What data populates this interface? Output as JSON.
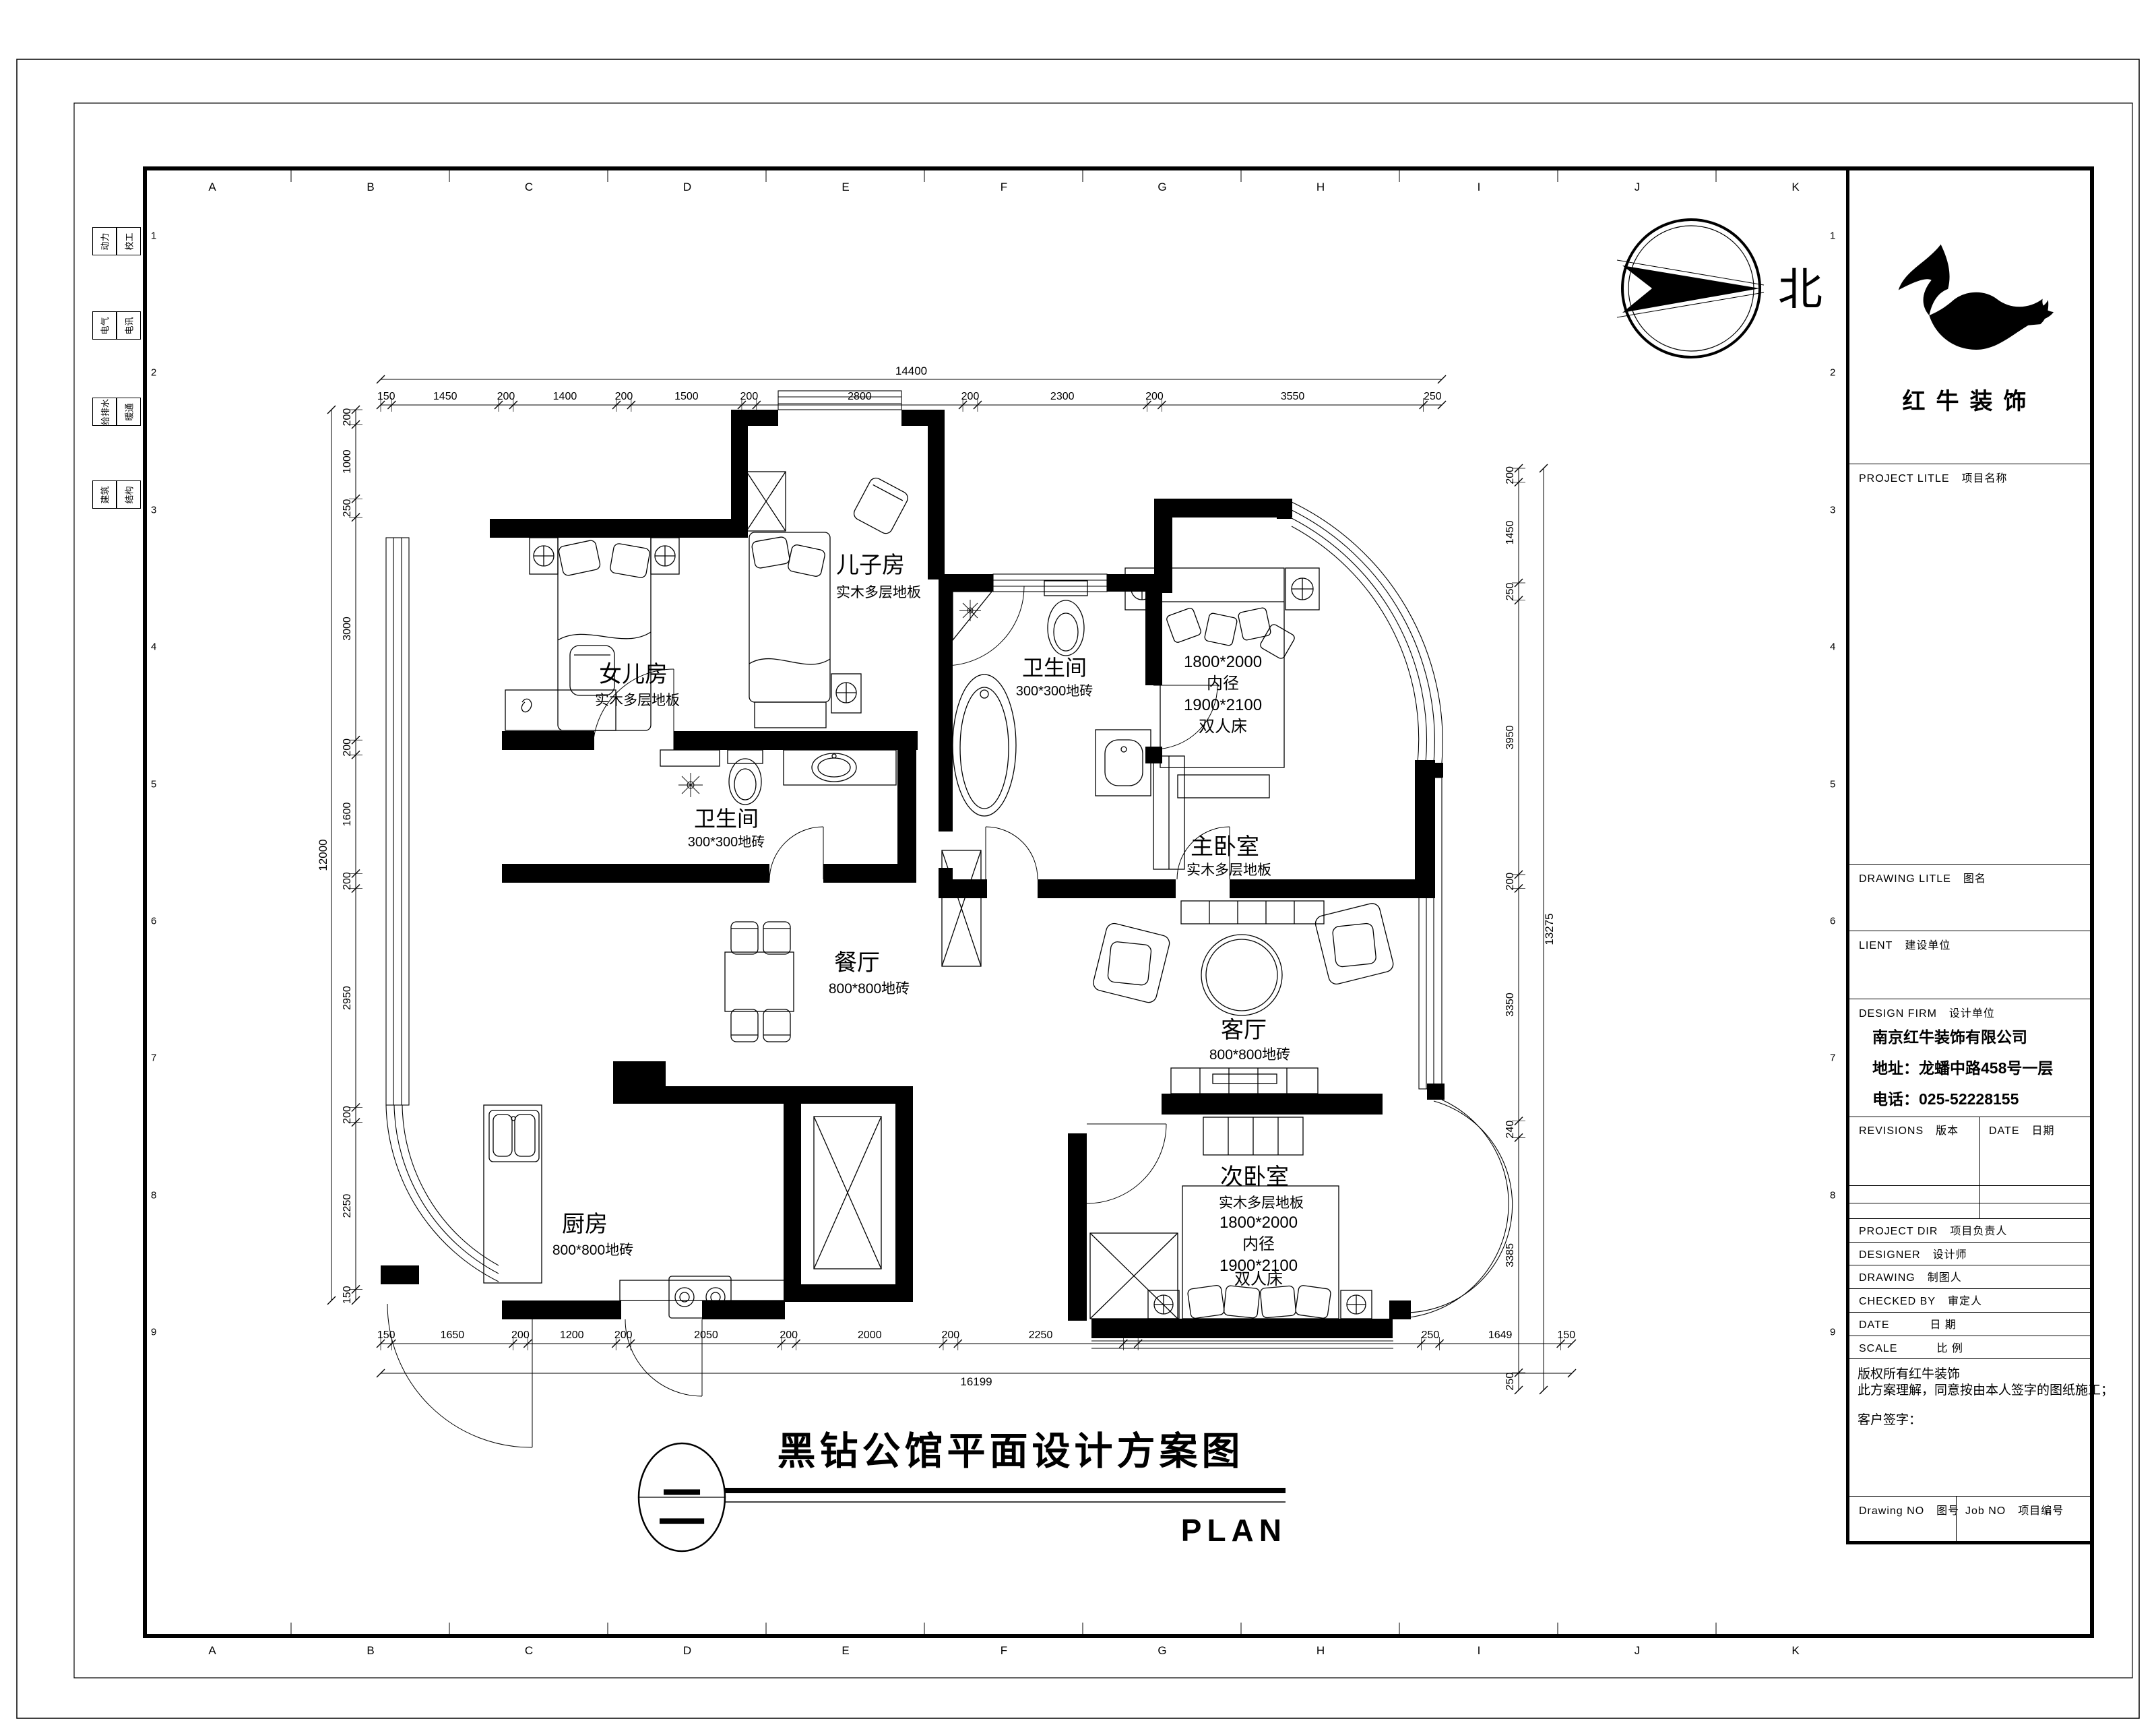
{
  "sheet": {
    "grid_letters": [
      "A",
      "B",
      "C",
      "D",
      "E",
      "F",
      "G",
      "H",
      "I",
      "J",
      "K"
    ],
    "row_numbers": [
      "1",
      "2",
      "3",
      "4",
      "5",
      "6",
      "7",
      "8",
      "9"
    ],
    "disciplines": [
      [
        "动力",
        "校工"
      ],
      [
        "电气",
        "电讯"
      ],
      [
        "给排水",
        "暖通"
      ],
      [
        "建筑",
        "结构"
      ]
    ]
  },
  "north": {
    "label": "北"
  },
  "rooms": {
    "daughter": {
      "name": "女儿房",
      "floor": "实木多层地板"
    },
    "son": {
      "name": "儿子房",
      "floor": "实木多层地板"
    },
    "bath_top": {
      "name": "卫生间",
      "floor": "300*300地砖"
    },
    "master": {
      "name": "主卧室",
      "floor": "实木多层地板"
    },
    "bath_mid": {
      "name": "卫生间",
      "floor": "300*300地砖"
    },
    "dining": {
      "name": "餐厅",
      "floor": "800*800地砖"
    },
    "living": {
      "name": "客厅",
      "floor": "800*800地砖"
    },
    "kitchen": {
      "name": "厨房",
      "floor": "800*800地砖"
    },
    "second": {
      "name": "次卧室",
      "floor": "实木多层地板"
    }
  },
  "beds": {
    "master": [
      "1800*2000",
      "内径",
      "1900*2100",
      "双人床"
    ],
    "second": [
      "1800*2000",
      "内径",
      "1900*2100",
      "双人床"
    ]
  },
  "dimensions": {
    "top": {
      "total": "14400",
      "segments": [
        "150",
        "1450",
        "200",
        "1400",
        "200",
        "1500",
        "200",
        "2800",
        "200",
        "2300",
        "200",
        "3550",
        "250"
      ]
    },
    "bottom": {
      "total": "16199",
      "segments": [
        "150",
        "1650",
        "200",
        "1200",
        "200",
        "2050",
        "200",
        "2000",
        "200",
        "2250",
        "200",
        "3850",
        "250",
        "1649",
        "150"
      ]
    },
    "left": {
      "total": "12000",
      "segments": [
        "200",
        "1000",
        "250",
        "3000",
        "200",
        "1600",
        "200",
        "2950",
        "200",
        "2250",
        "150"
      ]
    },
    "right": {
      "total": "13275",
      "segments": [
        "200",
        "1450",
        "250",
        "3950",
        "200",
        "3350",
        "240",
        "3385",
        "250"
      ]
    }
  },
  "title_bar": {
    "index": "二",
    "title": "黑钻公馆平面设计方案图",
    "subtitle": "PLAN"
  },
  "title_block": {
    "brand": "红牛装饰",
    "fields": {
      "project": {
        "en": "PROJECT LITLE",
        "zh": "项目名称"
      },
      "drawing_title": {
        "en": "DRAWING LITLE",
        "zh": "图名"
      },
      "client": {
        "en": "LIENT",
        "zh": "建设单位"
      },
      "design_firm": {
        "en": "DESIGN FIRM",
        "zh": "设计单位"
      },
      "revisions": {
        "en": "REVISIONS",
        "zh": "版本"
      },
      "date_col": {
        "en": "DATE",
        "zh": "日期"
      },
      "project_dir": {
        "en": "PROJECT DIR",
        "zh": "项目负责人"
      },
      "designer": {
        "en": "DESIGNER",
        "zh": "设计师"
      },
      "drawing_by": {
        "en": "DRAWING",
        "zh": "制图人"
      },
      "checked_by": {
        "en": "CHECKED BY",
        "zh": "审定人"
      },
      "date_row": {
        "en": "DATE",
        "zh": "日  期"
      },
      "scale_row": {
        "en": "SCALE",
        "zh": "比  例"
      },
      "drawing_no": {
        "en": "Drawing NO",
        "zh": "图号"
      },
      "job_no": {
        "en": "Job NO",
        "zh": "项目编号"
      }
    },
    "company": {
      "name": "南京红牛装饰有限公司",
      "address": "地址：龙蟠中路458号一层",
      "phone": "电话：025-52228155"
    },
    "notes": [
      "版权所有红牛装饰",
      "此方案理解，同意按由本人签字的图纸施工；",
      "客户签字："
    ]
  }
}
